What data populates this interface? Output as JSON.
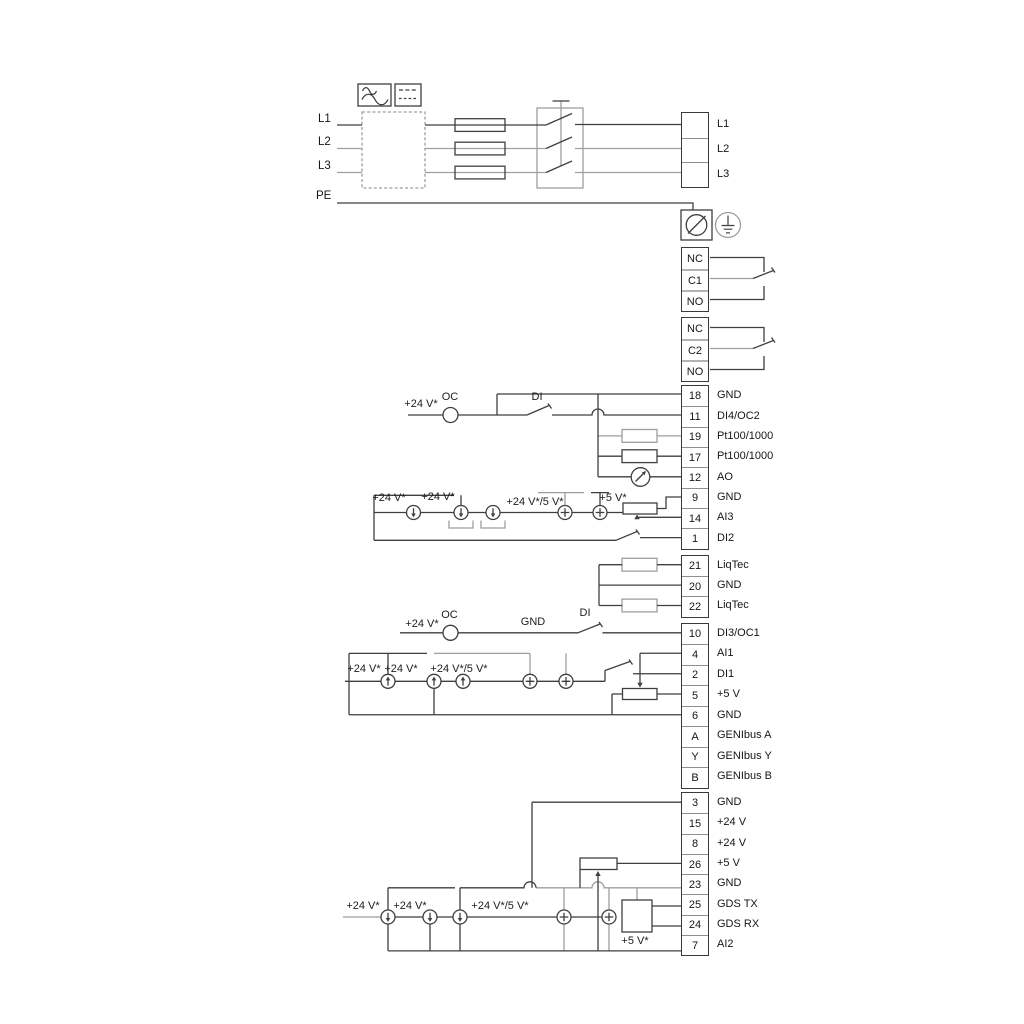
{
  "diagram": {
    "kind": "pump-drive wiring diagram"
  },
  "power_in": {
    "l1": "L1",
    "l2": "L2",
    "l3": "L3",
    "pe": "PE"
  },
  "power_out": {
    "rows": [
      {
        "num": "",
        "label": "L1"
      },
      {
        "num": "",
        "label": "L2"
      },
      {
        "num": "",
        "label": "L3"
      }
    ]
  },
  "relay1": {
    "rows": [
      {
        "num": "NC"
      },
      {
        "num": "C1"
      },
      {
        "num": "NO"
      }
    ]
  },
  "relay2": {
    "rows": [
      {
        "num": "NC"
      },
      {
        "num": "C2"
      },
      {
        "num": "NO"
      }
    ]
  },
  "io1": {
    "rows": [
      {
        "num": "18",
        "label": "GND"
      },
      {
        "num": "11",
        "label": "DI4/OC2"
      },
      {
        "num": "19",
        "label": "Pt100/1000"
      },
      {
        "num": "17",
        "label": "Pt100/1000"
      },
      {
        "num": "12",
        "label": "AO"
      },
      {
        "num": "9",
        "label": "GND"
      },
      {
        "num": "14",
        "label": "AI3"
      },
      {
        "num": "1",
        "label": "DI2"
      }
    ]
  },
  "liqtec": {
    "rows": [
      {
        "num": "21",
        "label": "LiqTec"
      },
      {
        "num": "20",
        "label": "GND"
      },
      {
        "num": "22",
        "label": "LiqTec"
      }
    ]
  },
  "io2": {
    "rows": [
      {
        "num": "10",
        "label": "DI3/OC1"
      },
      {
        "num": "4",
        "label": "AI1"
      },
      {
        "num": "2",
        "label": "DI1"
      },
      {
        "num": "5",
        "label": "+5 V"
      },
      {
        "num": "6",
        "label": "GND"
      },
      {
        "num": "A",
        "label": "GENIbus A"
      },
      {
        "num": "Y",
        "label": "GENIbus Y"
      },
      {
        "num": "B",
        "label": "GENIbus B"
      }
    ]
  },
  "io3": {
    "rows": [
      {
        "num": "3",
        "label": "GND"
      },
      {
        "num": "15",
        "label": "+24 V"
      },
      {
        "num": "8",
        "label": "+24 V"
      },
      {
        "num": "26",
        "label": "+5 V"
      },
      {
        "num": "23",
        "label": "GND"
      },
      {
        "num": "25",
        "label": "GDS TX"
      },
      {
        "num": "24",
        "label": "GDS RX"
      },
      {
        "num": "7",
        "label": "AI2"
      }
    ]
  },
  "annotations": {
    "sec1_v24": "+24 V*",
    "sec1_oc": "OC",
    "sec1_di": "DI",
    "sec2_v24a": "+24 V*",
    "sec2_v24b": "+24 V*",
    "sec2_v245": "+24 V*/5 V*",
    "sec2_v5": "+5 V*",
    "sec3_v24": "+24 V*",
    "sec3_oc": "OC",
    "sec3_gnd": "GND",
    "sec3_di": "DI",
    "sec3_v24a": "+24 V*",
    "sec3_v24b": "+24 V*",
    "sec3_v245": "+24 V*/5 V*",
    "sec4_v24a": "+24 V*",
    "sec4_v24b": "+24 V*",
    "sec4_v245": "+24 V*/5 V*",
    "sec4_v5": "+5 V*"
  },
  "colors": {
    "line_dark": "#3f3f3f",
    "line_gray": "#9e9e9e"
  }
}
